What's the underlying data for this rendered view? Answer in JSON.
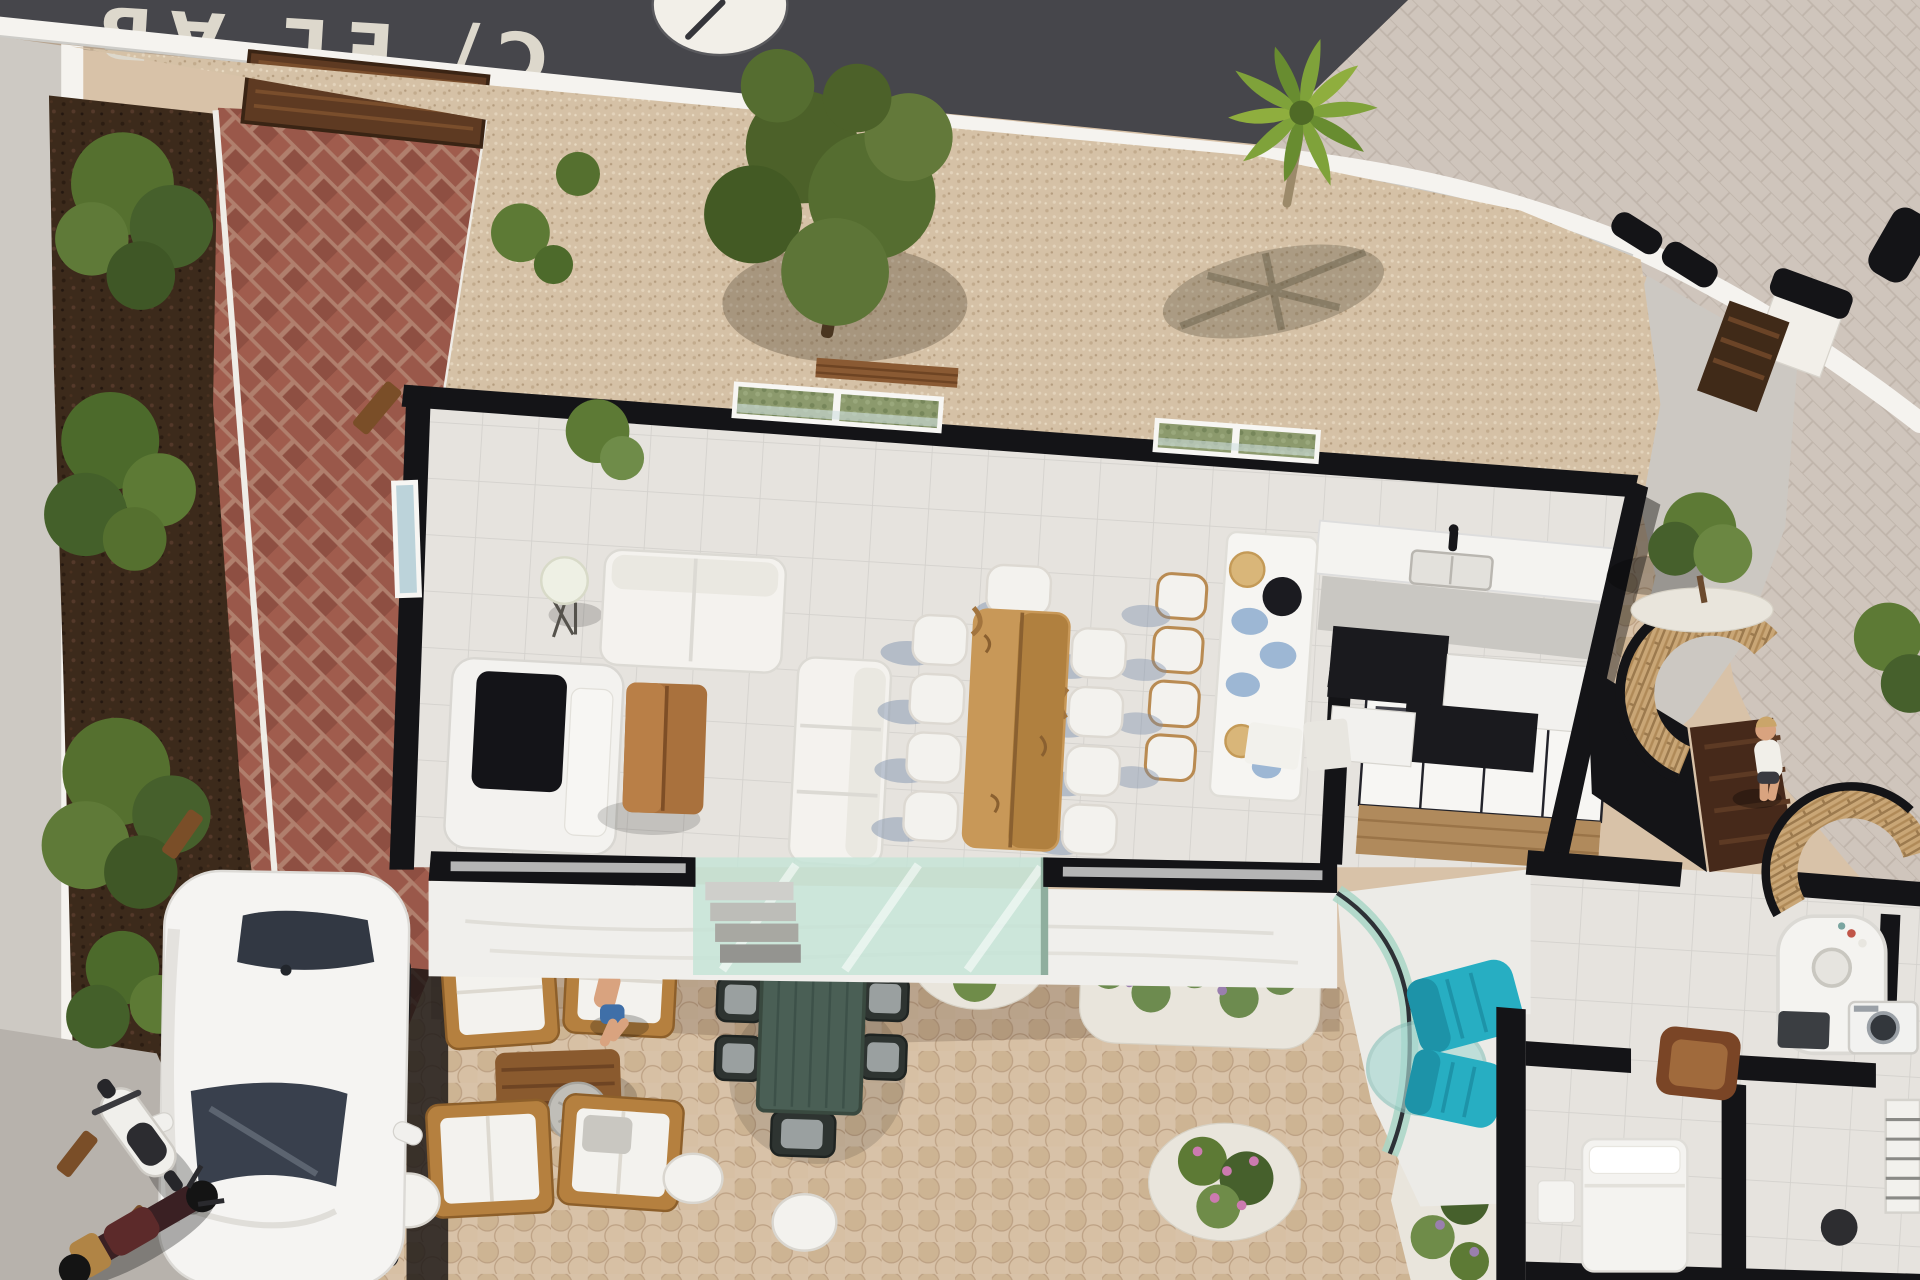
{
  "scene": {
    "type": "3d-architectural-aerial-render",
    "description": "Top-down 3D render of a modern single-storey villa with cutaway black wall caps, gravel yard, cobble patio, brick driveway, pool-side sunken lounge and guest wing"
  },
  "street": {
    "name_marking": "C/ EL AB",
    "marking_note": "street name painted upside-down on asphalt",
    "round_marking": "white circle road marking"
  },
  "objects": [
    {
      "id": "road",
      "label": "asphalt street"
    },
    {
      "id": "boundary-wall",
      "label": "white perimeter wall"
    },
    {
      "id": "entrance-gate",
      "label": "gate pillars with black caps and wood gate leaf"
    },
    {
      "id": "driveway",
      "label": "herringbone brick driveway"
    },
    {
      "id": "car",
      "label": "white sedan parked on driveway"
    },
    {
      "id": "scooter",
      "label": "white scooter"
    },
    {
      "id": "motorbike",
      "label": "dark red motorbike"
    },
    {
      "id": "olive-tree",
      "label": "large olive tree"
    },
    {
      "id": "palm-tree",
      "label": "palm tree"
    },
    {
      "id": "living-room",
      "label": "living room with white L-sofa, TV unit, wood coffee table, floor lamp"
    },
    {
      "id": "dining",
      "label": "live-edge wood dining table with eight white chairs"
    },
    {
      "id": "kitchen",
      "label": "kitchen with breakfast bar, four stools, double sink, black and white cabinets"
    },
    {
      "id": "wardrobe-corridor",
      "label": "dressing corridor with sliding-glass wardrobe"
    },
    {
      "id": "sunken-lounge",
      "label": "sunken patio with curved glass and teal armchairs with glass table"
    },
    {
      "id": "guest-wing",
      "label": "bedroom wing with shower pod, washer, bed and brown armchair"
    },
    {
      "id": "entrance-person",
      "label": "person at pivot entrance door"
    },
    {
      "id": "seated-person",
      "label": "man seated on outdoor lounge chair"
    },
    {
      "id": "outdoor-lounge",
      "label": "timber lounge set with white cushions and pouf"
    },
    {
      "id": "outdoor-dining",
      "label": "green outdoor dining table with dark chairs"
    },
    {
      "id": "flower-beds",
      "label": "lavender and pink flower beds on white pebbles"
    },
    {
      "id": "wicker-walls",
      "label": "curved dry-stone entrance planters"
    }
  ],
  "palette": {
    "road": "#46464b",
    "asphaltText": "#ddd8cc",
    "boundaryWall": "#f5f3ef",
    "sidewalk": "#cfc5bc",
    "gravel": "#d5c1a6",
    "cobble": "#d8c2a8",
    "brick": "#9a584a",
    "mortar": "#b07f6d",
    "mulch": "#3c2a1b",
    "foliage": "#5d7a35",
    "foliageDark": "#46602c",
    "palm": "#7fa23a",
    "houseFloor": "#e6e3de",
    "wallBlack": "#141417",
    "woodWarm": "#a9713d",
    "woodDark": "#8a5a2e",
    "teal": "#27aec2",
    "tealDark": "#1d93a8",
    "glassMint": "#c5e4d7",
    "glassBlue": "#bcd3da",
    "skin": "#d9a37f",
    "furnWhite": "#f3f2ee",
    "greyPave": "#b7b2ac",
    "carWhite": "#f5f4f2",
    "windowGlassDark": "#39404d",
    "outdoorTableGreen": "#4a5f55",
    "lavender": "#9a7fae",
    "pinkFlower": "#cc7ab0",
    "pebble": "#e9e5dc",
    "doorBrown": "#46291a",
    "pathGrey": "#ccc8c2"
  }
}
